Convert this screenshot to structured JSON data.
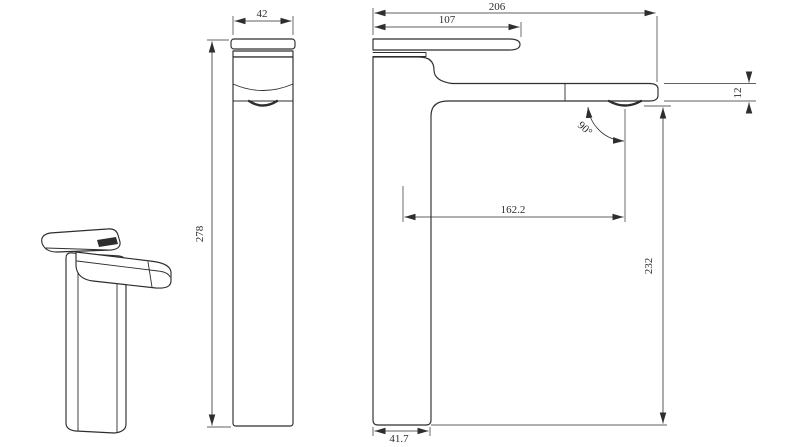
{
  "drawing": {
    "colors": {
      "background": "#ffffff",
      "line": "#2e2e2e"
    },
    "dimensions": {
      "handle_width": "42",
      "overall_height": "278",
      "handle_reach": "107",
      "overall_reach": "206",
      "spout_tip_thickness": "12",
      "spout_reach": "162.2",
      "spout_height": "232",
      "base_depth": "41.7",
      "outlet_angle": "90°"
    }
  }
}
